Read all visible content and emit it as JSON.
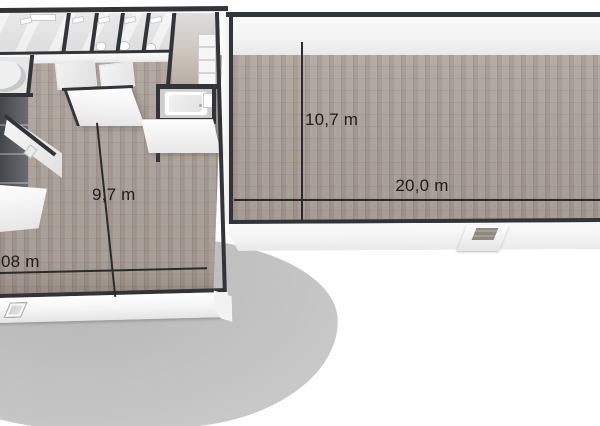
{
  "scene": {
    "description": "3D rendered floor plan, bird's-eye view: multi-room unit on the left connected to a long empty hall on the right, with dimension lines"
  },
  "measurements": {
    "hall_depth": "10,7 m",
    "hall_length": "20,0 m",
    "room_depth": "9,7 m",
    "room_width_partial": "08 m"
  },
  "windows": {
    "pane_count": 10
  },
  "colors": {
    "background": "#ffffff",
    "wall": "#313438",
    "wall_face_light": "#fafafa",
    "wall_face_shade": "#e9e9e9",
    "carpet_base": "#a8a098",
    "tile_floor": "#b6aba0",
    "stall_floor": "#dcdcdc",
    "shadow_blob": "#c1c1c1",
    "glass": "#d0d0d0",
    "dimension_line": "#2b2b2b",
    "dimension_text": "#1d1d1d"
  }
}
